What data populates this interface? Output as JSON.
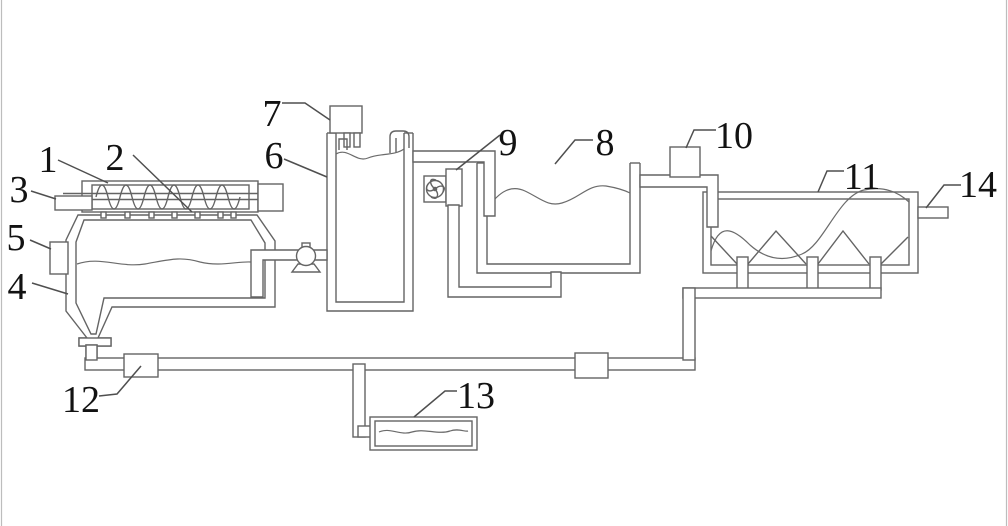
{
  "canvas": {
    "width": 1008,
    "height": 526,
    "background": "#ffffff",
    "line_color": "#646464",
    "label_color": "#121212"
  },
  "figure": {
    "kind": "patent process-flow line drawing",
    "symbols": [
      "screw-conveyor-spiral",
      "centrifugal-pump",
      "fan-impeller",
      "zigzag-baffles",
      "liquid-wave-lines"
    ]
  },
  "labels": {
    "l1": "1",
    "l2": "2",
    "l3": "3",
    "l4": "4",
    "l5": "5",
    "l6": "6",
    "l7": "7",
    "l8": "8",
    "l9": "9",
    "l10": "10",
    "l11": "11",
    "l12": "12",
    "l13": "13",
    "l14": "14"
  }
}
